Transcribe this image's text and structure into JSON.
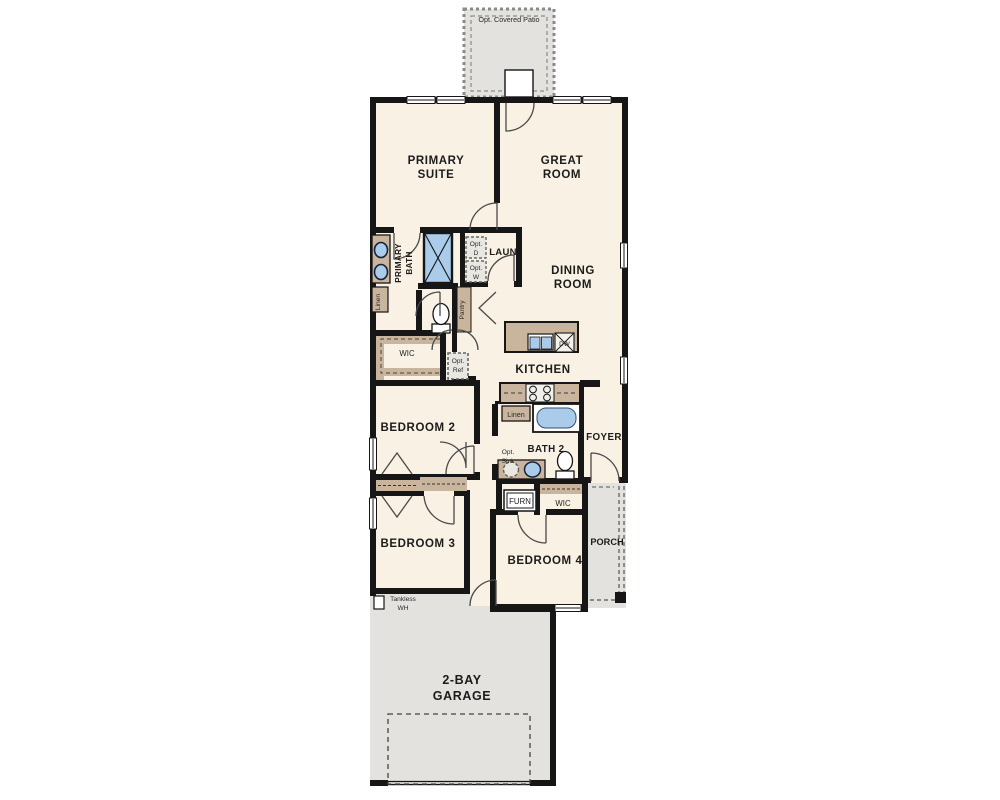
{
  "plan": {
    "type": "single-story floor plan",
    "labels": {
      "patio": "Opt. Covered Patio",
      "primary_suite_1": "PRIMARY",
      "primary_suite_2": "SUITE",
      "great_room_1": "GREAT",
      "great_room_2": "ROOM",
      "primary_bath_1": "PRIMARY",
      "primary_bath_2": "BATH",
      "laundry": "LAUN",
      "opt_dryer_1": "Opt.",
      "opt_dryer_2": "D",
      "opt_washer_1": "Opt.",
      "opt_washer_2": "W",
      "linen_primary": "Linen",
      "pantry": "Pantry",
      "dining_1": "DINING",
      "dining_2": "ROOM",
      "kitchen": "KITCHEN",
      "dishwasher": "DW",
      "wic_primary": "WIC",
      "opt_ref_1": "Opt.",
      "opt_ref_2": "Ref",
      "bedroom2": "BEDROOM 2",
      "linen_hall": "Linen",
      "bath2": "BATH 2",
      "opt_sink_1": "Opt.",
      "opt_sink_2": "Sink",
      "foyer": "FOYER",
      "furnace": "FURN",
      "wic_bedroom4": "WIC",
      "bedroom3": "BEDROOM 3",
      "bedroom4": "BEDROOM 4",
      "porch": "PORCH",
      "tankless_1": "Tankless",
      "tankless_2": "WH",
      "garage_1": "2-BAY",
      "garage_2": "GARAGE"
    },
    "colors": {
      "wall": "#161616",
      "floor": "#f8f1e4",
      "exterior_zone": "#e3e2df",
      "cabinet": "#c9b59d",
      "fixture_blue": "#aacbe9",
      "stove": "#f0efe9",
      "dash_line": "#666666",
      "text": "#1c1c1c"
    }
  }
}
